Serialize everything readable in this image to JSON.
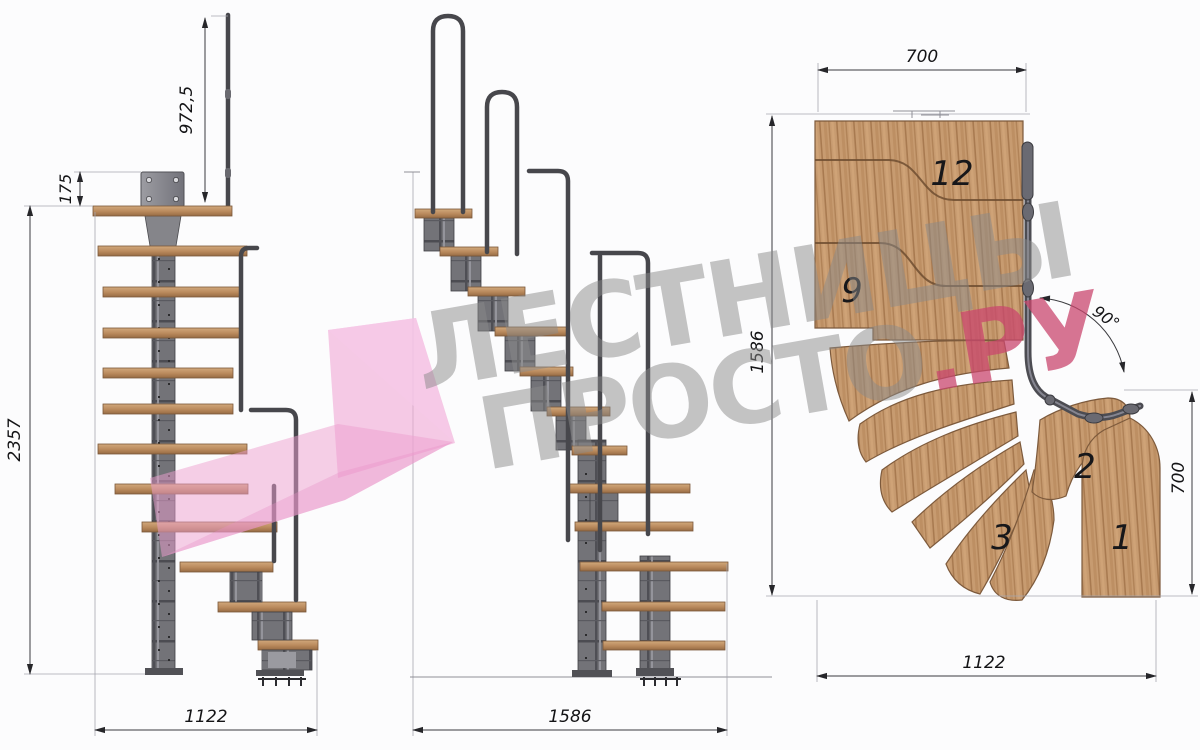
{
  "watermark": {
    "line1": "ЛЕСТНИЦЫ",
    "line2_main": "ПРОСТО",
    "line2_accent": ".РУ",
    "gray": "#8a8a8a",
    "red": "#c9476d",
    "pink": "#f0a6d6"
  },
  "views": {
    "front": {
      "dims": {
        "rail_height": "972,5",
        "plate_height": "175",
        "total_height": "2357",
        "depth": "1122"
      }
    },
    "side": {
      "dims": {
        "run": "1586"
      }
    },
    "plan": {
      "dims": {
        "top_width": "700",
        "left_depth": "1586",
        "angle": "90°",
        "right_width": "700",
        "bottom_width": "1122"
      },
      "steps": [
        "12",
        "9",
        "2",
        "3",
        "1"
      ]
    }
  },
  "colors": {
    "wood": "#c69a6f",
    "metal": "#737378",
    "dim_lines": "#3a3a3e",
    "background": "#fcfcfd"
  }
}
